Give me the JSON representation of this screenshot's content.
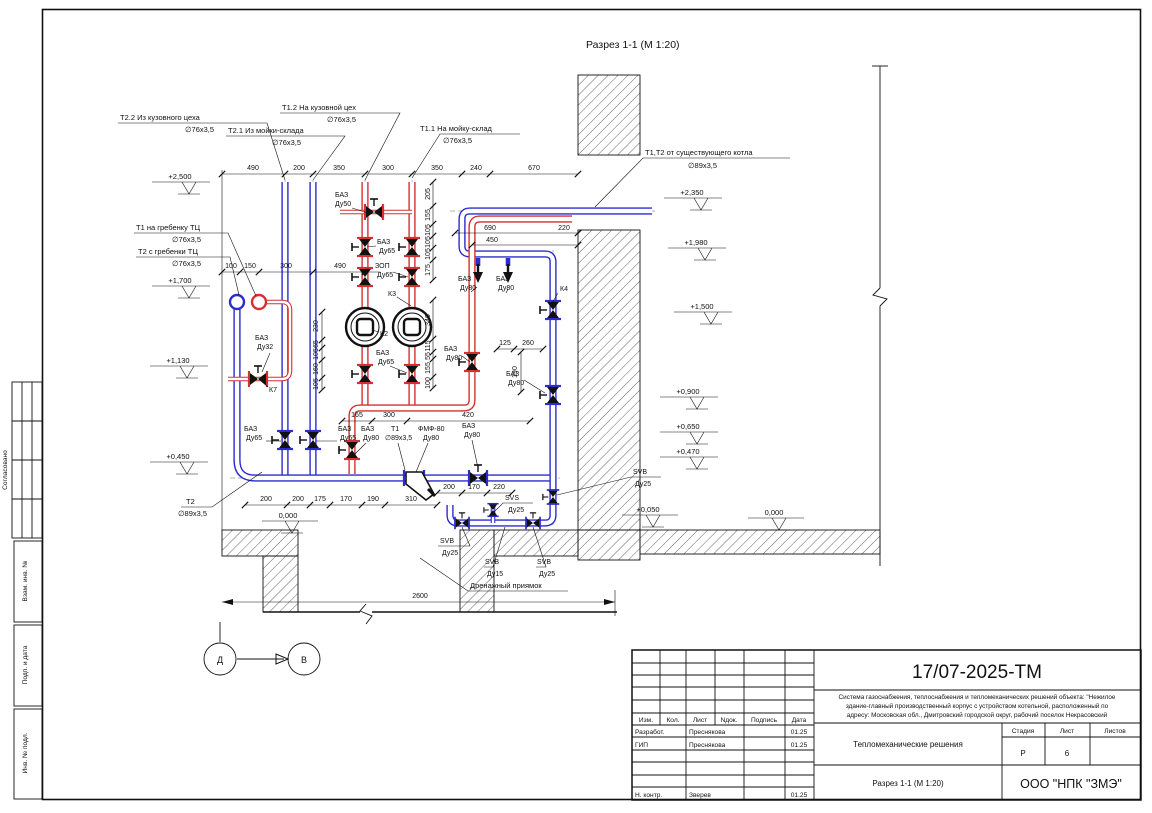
{
  "view": {
    "title": "Разрез 1-1 (М 1:20)"
  },
  "markers": {
    "d": "Д",
    "v": "В"
  },
  "flow": [
    {
      "text": "Т2.2 Из кузовного цеха",
      "dia": "∅76х3,5"
    },
    {
      "text": "Т2.1 Из мойки-склада",
      "dia": "∅76х3,5"
    },
    {
      "text": "Т1.2 На кузовной цех",
      "dia": "∅76х3,5"
    },
    {
      "text": "Т1.1 На мойку-склад",
      "dia": "∅76х3,5"
    },
    {
      "text": "Т1,Т2 от существующего котла",
      "dia": "∅89х3,5"
    },
    {
      "text": "Т1 на гребенку ТЦ",
      "dia": "∅76х3,5"
    },
    {
      "text": "Т2 с гребенки ТЦ",
      "dia": "∅76х3,5"
    },
    {
      "text": "Т2",
      "dia": "∅89х3,5"
    }
  ],
  "tags": [
    {
      "l1": "БАЗ",
      "l2": "Ду50"
    },
    {
      "l1": "БАЗ",
      "l2": "Ду65"
    },
    {
      "l1": "ЗОП",
      "l2": "Ду65"
    },
    {
      "l1": "К3",
      "l2": ""
    },
    {
      "l1": "К2",
      "l2": ""
    },
    {
      "l1": "БАЗ",
      "l2": "Ду65"
    },
    {
      "l1": "БАЗ",
      "l2": "Ду80"
    },
    {
      "l1": "БАЗ",
      "l2": "Ду80"
    },
    {
      "l1": "БАЗ",
      "l2": "Ду80"
    },
    {
      "l1": "БАЗ",
      "l2": "Ду80"
    },
    {
      "l1": "К4",
      "l2": ""
    },
    {
      "l1": "БАЗ",
      "l2": "Ду32"
    },
    {
      "l1": "К7",
      "l2": ""
    },
    {
      "l1": "БАЗ",
      "l2": "Ду65"
    },
    {
      "l1": "БАЗ",
      "l2": "Ду65"
    },
    {
      "l1": "БАЗ",
      "l2": "Ду80"
    },
    {
      "l1": "Т1",
      "l2": "∅89х3,5"
    },
    {
      "l1": "ФМФ-80",
      "l2": "Ду80"
    },
    {
      "l1": "БАЗ",
      "l2": "Ду80"
    },
    {
      "l1": "SVB",
      "l2": "Ду25"
    },
    {
      "l1": "SVS",
      "l2": "Ду25"
    },
    {
      "l1": "SVB",
      "l2": "Ду15"
    },
    {
      "l1": "SVB",
      "l2": "Ду25"
    },
    {
      "l1": "SVB",
      "l2": "Ду25"
    }
  ],
  "drain_label": "Дренажный приямок",
  "elev": {
    "left": [
      "+2,500",
      "+1,700",
      "+1,130",
      "+0,450"
    ],
    "right": [
      "+2,350",
      "+1,980",
      "+1,500",
      "+0,900",
      "+0,650",
      "+0,470",
      "+0,050",
      "0,000"
    ],
    "floor": "0,000"
  },
  "dims": {
    "top": [
      "490",
      "200",
      "350",
      "300",
      "350",
      "240",
      "670"
    ],
    "left2": [
      "100",
      "150",
      "300",
      "490"
    ],
    "vleft": [
      "230",
      "65",
      "105",
      "160",
      "105"
    ],
    "vru": [
      "205",
      "155",
      "105",
      "105",
      "105",
      "175"
    ],
    "vrl": [
      "340",
      "115",
      "55",
      "155",
      "100"
    ],
    "c690": "690",
    "c450": "450",
    "c220": "220",
    "c125": "125",
    "c260": "260",
    "c190": "190",
    "bottom1": [
      "165",
      "300",
      "420"
    ],
    "bottom2": [
      "200",
      "200",
      "175",
      "170",
      "190",
      "310"
    ],
    "bottom3": [
      "200",
      "170",
      "220"
    ],
    "overall": "2600"
  },
  "titleblock": {
    "doc": "17/07-2025-ТМ",
    "desc1": "Система газоснабжения, теплоснабжения и тепломеханических решений объекта: \"Нежилое",
    "desc2": "здание-главный производственный корпус с устройством котельной, расположенный по",
    "desc3": "адресу: Московская обл., Дмитровский городской округ, рабочий поселок Некрасовский",
    "cols": {
      "izm": "Изм.",
      "kol": "Кол.",
      "list": "Лист",
      "ndok": "Nдок.",
      "podpis": "Подпись",
      "data": "Дата"
    },
    "rows": [
      {
        "role": "Разработ.",
        "name": "Преснякова",
        "date": "01.25"
      },
      {
        "role": "ГИП",
        "name": "Преснякова",
        "date": "01.25"
      },
      {
        "role": "Н. контр.",
        "name": "Зверев",
        "date": "01.25"
      }
    ],
    "doc_title": "Тепломеханические решения",
    "stage_h": "Стадия",
    "sheet_h": "Лист",
    "sheets_h": "Листов",
    "stage": "Р",
    "sheet": "6",
    "view_ref": "Разрез 1-1 (М 1:20)",
    "company": "ООО \"НПК \"ЗМЭ\""
  },
  "sidebar": {
    "agreed": "Согласовано",
    "vzam": "Взам. инв. №",
    "podp": "Подп. и дата",
    "inv": "Инв. № подл."
  }
}
